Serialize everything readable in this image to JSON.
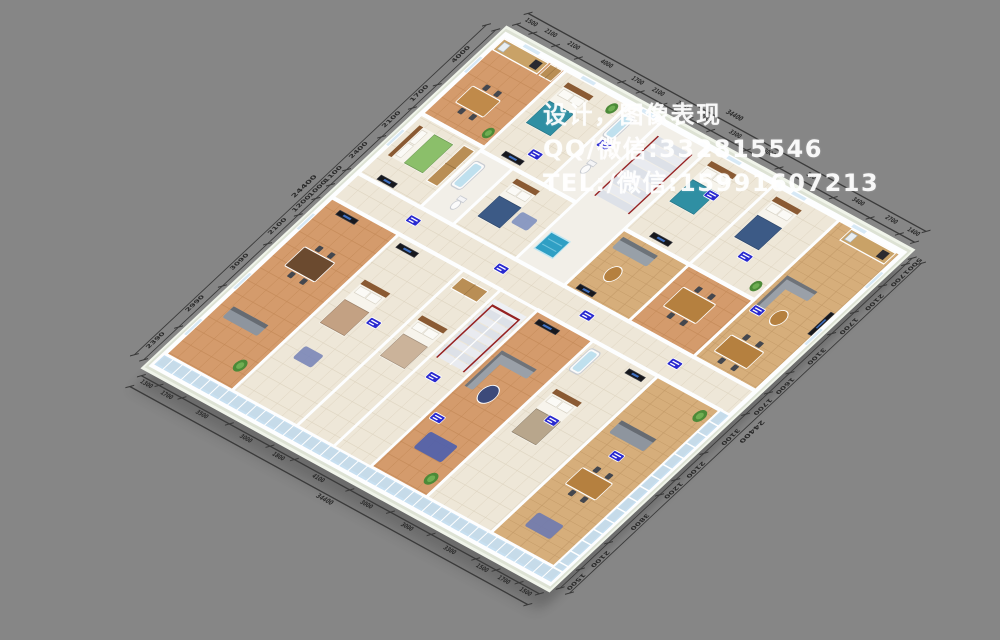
{
  "background": "#868686",
  "watermark": {
    "line1": "设计，图像表现",
    "line2": "QQ/微信:332815546",
    "line3": "TEL:/微信:15991607213"
  },
  "palette": {
    "slab": "#dde2d4",
    "slab_edge": "#f0f4ea",
    "base": "#efe8d9",
    "wall": "#fdfeff",
    "glass": "#bcd9ee",
    "dim_line": "#3a3a3a",
    "dim_text": "#2b2b2b",
    "tag": "#2a2ad0",
    "railing": "#962222",
    "stair_hall_floor": "#f2efe8"
  },
  "dimensions": {
    "edges": [
      {
        "name": "top-right",
        "labels": [
          "1500",
          "2100",
          "2100",
          "4000",
          "1700",
          "2100",
          "2400",
          "2000",
          "3300",
          "3000",
          "5000",
          "3400",
          "2700",
          "1400"
        ],
        "total": "34400"
      },
      {
        "name": "top-left",
        "labels": [
          "4000",
          "1700",
          "2100",
          "2400",
          "1100",
          "1000",
          "1200",
          "2100",
          "3090",
          "2990",
          "2390"
        ],
        "total": "24400"
      },
      {
        "name": "bottom-left",
        "labels": [
          "1300",
          "1700",
          "3500",
          "3000",
          "1800",
          "4100",
          "3000",
          "3000",
          "3300",
          "1500",
          "1700",
          "1500"
        ],
        "total": "34400"
      },
      {
        "name": "bottom-right",
        "labels": [
          "500",
          "1700",
          "2100",
          "1700",
          "3100",
          "1600",
          "1700",
          "3100",
          "2100",
          "1200",
          "3800",
          "2100",
          "1500"
        ],
        "total": "24400"
      }
    ]
  },
  "plan": {
    "width": 344,
    "height": 244,
    "corridors": [
      [
        0,
        102,
        344,
        18
      ],
      [
        146,
        120,
        32,
        116
      ]
    ],
    "rooms": [
      {
        "name": "kitchen-dining-north",
        "bounds": [
          0,
          0,
          54,
          58
        ],
        "floor": "warm",
        "items": [
          [
            "counter",
            2,
            2,
            38,
            8
          ],
          [
            "wardrobe",
            42,
            2,
            10,
            8
          ],
          [
            "table",
            12,
            32,
            24,
            12,
            "#c08a4a"
          ],
          [
            "plant",
            48,
            50,
            3.5
          ]
        ]
      },
      {
        "name": "bedroom-northwest",
        "bounds": [
          0,
          58,
          54,
          44
        ],
        "floor": "cream",
        "items": [
          [
            "bed",
            6,
            64,
            30,
            22,
            "#8bbf6a"
          ],
          [
            "wardrobe",
            42,
            62,
            9,
            26
          ],
          [
            "tv",
            14,
            97,
            14,
            3
          ]
        ]
      },
      {
        "name": "bedroom-north-1",
        "bounds": [
          54,
          0,
          54,
          60
        ],
        "floor": "cream",
        "items": [
          [
            "bed",
            62,
            6,
            22,
            30,
            "#2f8fa3"
          ],
          [
            "tv",
            68,
            54,
            16,
            3
          ],
          [
            "plant",
            101,
            7,
            3.5
          ]
        ]
      },
      {
        "name": "bathroom-1",
        "bounds": [
          54,
          60,
          28,
          42
        ],
        "floor": "white",
        "items": [
          [
            "tub",
            57,
            66,
            9,
            18
          ],
          [
            "toilet",
            72,
            92
          ]
        ]
      },
      {
        "name": "bedroom-north-2",
        "bounds": [
          82,
          60,
          54,
          42
        ],
        "floor": "cream",
        "items": [
          [
            "bed",
            90,
            64,
            20,
            28,
            "#3c5a86"
          ],
          [
            "rug",
            112,
            78,
            14,
            8,
            "#8091c0"
          ]
        ]
      },
      {
        "name": "bathroom-2",
        "bounds": [
          108,
          0,
          28,
          60
        ],
        "floor": "white",
        "items": [
          [
            "tub",
            111,
            6,
            9,
            16
          ],
          [
            "toilet",
            122,
            42
          ]
        ]
      },
      {
        "name": "stair-hall",
        "bounds": [
          136,
          0,
          42,
          102
        ],
        "floor": "white",
        "items": [
          [
            "stairS",
            142,
            8,
            30,
            44
          ],
          [
            "pool",
            140,
            80,
            16,
            12
          ]
        ]
      },
      {
        "name": "bedroom-north-3",
        "bounds": [
          178,
          0,
          56,
          60
        ],
        "floor": "cream",
        "items": [
          [
            "bed",
            186,
            6,
            22,
            30,
            "#2f8fa3"
          ],
          [
            "tv",
            196,
            54,
            16,
            3
          ]
        ]
      },
      {
        "name": "lounge-middle",
        "bounds": [
          178,
          60,
          56,
          42
        ],
        "floor": "wood",
        "items": [
          [
            "sofa",
            182,
            64,
            30,
            8,
            "#98a0a8"
          ],
          [
            "rtable",
            198,
            84,
            5,
            "#b5803f"
          ],
          [
            "tv",
            186,
            97,
            14,
            3
          ]
        ]
      },
      {
        "name": "bedroom-north-4",
        "bounds": [
          234,
          0,
          56,
          60
        ],
        "floor": "cream",
        "items": [
          [
            "bed",
            242,
            6,
            22,
            30,
            "#3c5a86"
          ],
          [
            "plant",
            283,
            53,
            3.5
          ]
        ]
      },
      {
        "name": "dining-middle",
        "bounds": [
          234,
          60,
          56,
          42
        ],
        "floor": "warm",
        "items": [
          [
            "table",
            244,
            72,
            28,
            14,
            "#b5803f"
          ]
        ]
      },
      {
        "name": "suite-east",
        "bounds": [
          290,
          0,
          54,
          102
        ],
        "floor": "wood",
        "items": [
          [
            "counter",
            302,
            2,
            38,
            8
          ],
          [
            "lsofa",
            294,
            40,
            26,
            24,
            "#9aa0a8"
          ],
          [
            "rtable",
            314,
            62,
            5,
            "#b5803f"
          ],
          [
            "tv",
            339,
            46,
            3,
            16
          ],
          [
            "table",
            298,
            82,
            28,
            12,
            "#b5803f"
          ]
        ]
      },
      {
        "name": "dining-west",
        "bounds": [
          0,
          120,
          58,
          116
        ],
        "floor": "warm",
        "items": [
          [
            "table",
            14,
            150,
            26,
            14,
            "#6b4a2f"
          ],
          [
            "sofa",
            10,
            196,
            30,
            8,
            "#8e959e"
          ],
          [
            "tv",
            12,
            124,
            16,
            3
          ],
          [
            "plant",
            48,
            222,
            4
          ]
        ]
      },
      {
        "name": "bedroom-south-1",
        "bounds": [
          58,
          120,
          56,
          116
        ],
        "floor": "cream",
        "items": [
          [
            "bed",
            66,
            150,
            22,
            32,
            "#c3a183"
          ],
          [
            "rug",
            72,
            196,
            16,
            9,
            "#7a86b8"
          ],
          [
            "tv",
            64,
            124,
            16,
            3
          ]
        ]
      },
      {
        "name": "bedroom-south-2",
        "bounds": [
          114,
          120,
          32,
          116
        ],
        "floor": "cream",
        "items": [
          [
            "bed",
            118,
            152,
            22,
            30,
            "#cbb39a"
          ],
          [
            "wardrobe",
            118,
            124,
            22,
            8
          ]
        ]
      },
      {
        "name": "living-south",
        "bounds": [
          178,
          120,
          48,
          116
        ],
        "floor": "warm",
        "items": [
          [
            "lsofa",
            182,
            148,
            30,
            26,
            "#9aa0a8"
          ],
          [
            "rtable",
            200,
            172,
            6,
            "#3c4a7a"
          ],
          [
            "tv",
            184,
            124,
            18,
            3
          ],
          [
            "rug",
            190,
            204,
            24,
            12,
            "#4d5fae"
          ],
          [
            "plant",
            218,
            226,
            4
          ]
        ]
      },
      {
        "name": "bedroom-south-3",
        "bounds": [
          226,
          120,
          56,
          116
        ],
        "floor": "cream",
        "items": [
          [
            "bed",
            234,
            152,
            22,
            32,
            "#b8a68c"
          ],
          [
            "tub",
            229,
            124,
            9,
            16
          ],
          [
            "tv",
            262,
            124,
            14,
            3
          ]
        ]
      },
      {
        "name": "living-south-2",
        "bounds": [
          282,
          120,
          54,
          116
        ],
        "floor": "wood",
        "items": [
          [
            "sofa",
            288,
            150,
            30,
            9,
            "#8e959e"
          ],
          [
            "table",
            294,
            182,
            26,
            12,
            "#b5803f"
          ],
          [
            "plant",
            328,
            128,
            4
          ],
          [
            "rug",
            296,
            214,
            22,
            10,
            "#6e7ab0"
          ]
        ]
      }
    ],
    "stairs": [
      [
        "stairU",
        148,
        126,
        28,
        42
      ]
    ],
    "balconies": [
      [
        0,
        236,
        344,
        8
      ],
      [
        336,
        120,
        8,
        116
      ]
    ],
    "windows": [
      [
        16,
        -1.3,
        14,
        2.6
      ],
      [
        66,
        -1.3,
        12,
        2.6
      ],
      [
        118,
        -1.3,
        12,
        2.6
      ],
      [
        192,
        -1.3,
        12,
        2.6
      ],
      [
        248,
        -1.3,
        12,
        2.6
      ],
      [
        300,
        -1.3,
        12,
        2.6
      ],
      [
        -1.3,
        16,
        2.6,
        12
      ],
      [
        -1.3,
        70,
        2.6,
        12
      ],
      [
        -1.3,
        132,
        2.6,
        12
      ],
      [
        -1.3,
        176,
        2.6,
        12
      ],
      [
        -1.3,
        210,
        2.6,
        12
      ],
      [
        342.7,
        14,
        2.6,
        12
      ],
      [
        342.7,
        56,
        2.6,
        12
      ]
    ],
    "tags": [
      [
        86,
        48
      ],
      [
        118,
        26
      ],
      [
        206,
        22
      ],
      [
        260,
        42
      ],
      [
        298,
        64
      ],
      [
        58,
        110
      ],
      [
        134,
        110
      ],
      [
        208,
        110
      ],
      [
        284,
        110
      ],
      [
        96,
        168
      ],
      [
        186,
        196
      ],
      [
        250,
        168
      ],
      [
        306,
        168
      ],
      [
        160,
        178
      ]
    ]
  }
}
